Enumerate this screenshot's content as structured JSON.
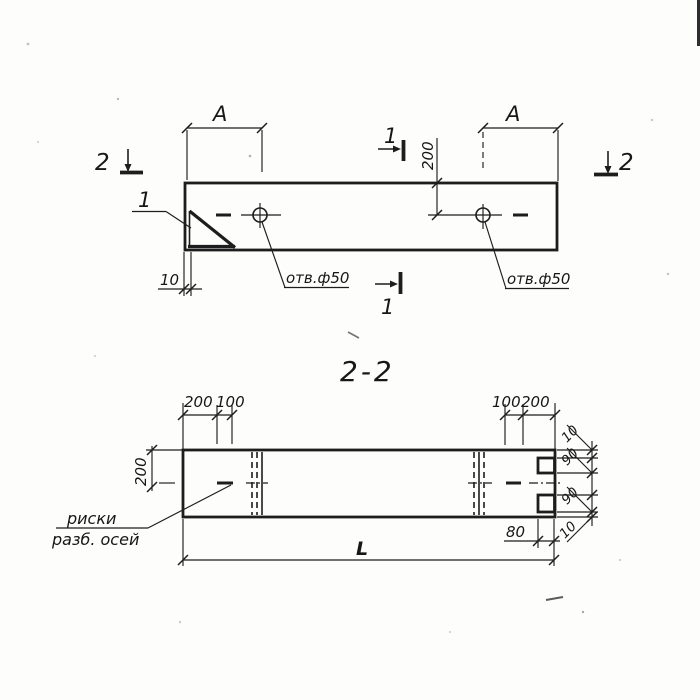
{
  "plan": {
    "dim_a_left": "A",
    "dim_a_right": "A",
    "dim_200": "200",
    "dim_10": "10",
    "section_2_left": "2",
    "section_2_right": "2",
    "section_1_top": "1",
    "section_1_bottom": "1",
    "detail_1": "1",
    "hole_label_left": "отв.ф50",
    "hole_label_right": "отв.ф50"
  },
  "section": {
    "title": "2-2",
    "dim_tl_200": "200",
    "dim_tl_100": "100",
    "dim_tr_100": "100",
    "dim_tr_200": "200",
    "dim_height_200": "200",
    "right_dims": [
      "10",
      "90",
      "90",
      "10"
    ],
    "dim_80": "80",
    "dim_length": "L",
    "note_line1": "риски",
    "note_line2": "разб. осей"
  },
  "colors": {
    "ink": "#1d1d1d",
    "paper": "#fdfdfc"
  }
}
